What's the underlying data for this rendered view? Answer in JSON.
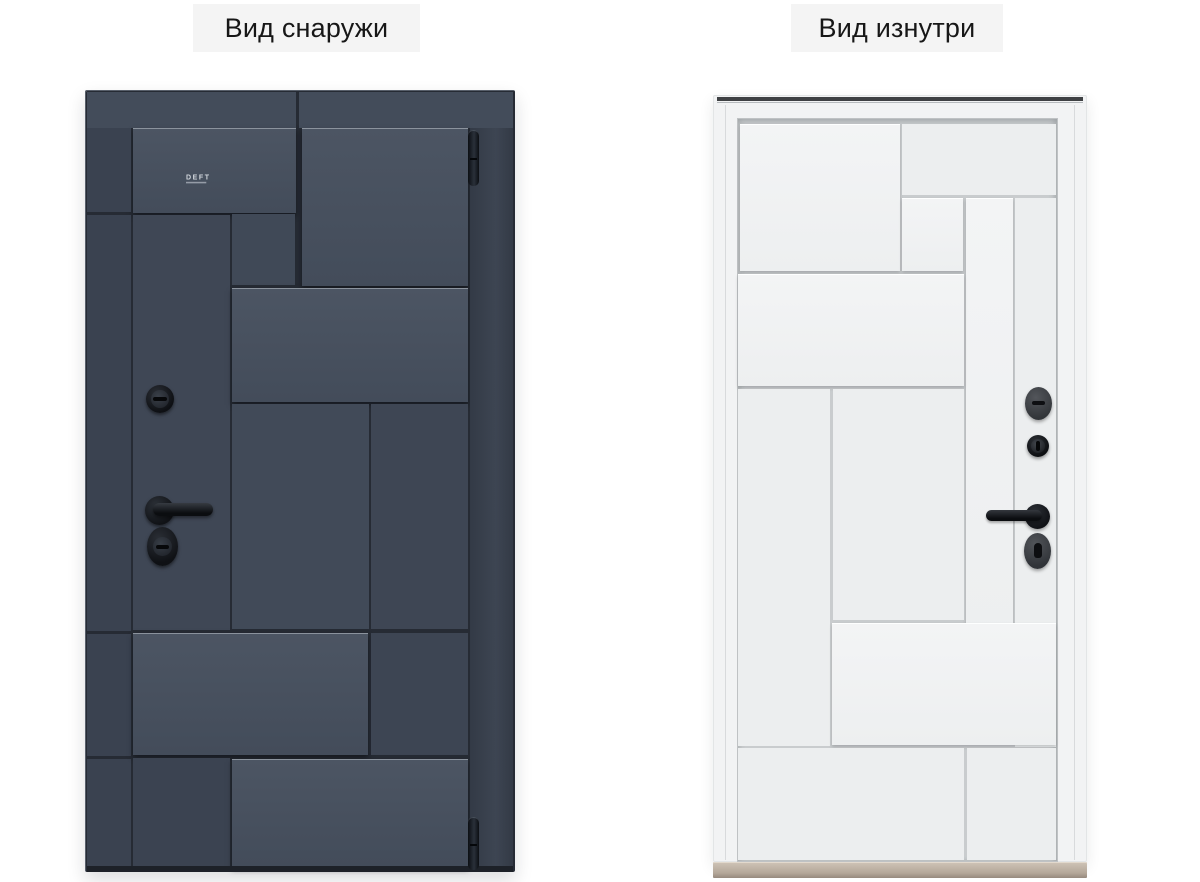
{
  "view_labels": {
    "outside": "Вид снаружи",
    "inside": "Вид изнутри"
  },
  "exterior_door": {
    "brand": "DEFT"
  },
  "colors": {
    "page_bg": "#ffffff",
    "label_bg": "#f4f4f4",
    "label_text": "#171717",
    "dark_seam": "#262b34",
    "dark_panel": "#434c5a",
    "dark_panel_light": "#4c5563",
    "dark_stile": "#3a4250",
    "dark_edge": "#333a46",
    "hw_black": "#15171b",
    "hw_gray": "#3d4044",
    "white_seam": "#c9ccce",
    "white_panel": "#eceeef",
    "white_panel_raised": "#f3f4f5",
    "frame_white": "#f2f3f4",
    "frame_top_strip": "#3f4144",
    "threshold_tan": "#b3a698"
  }
}
